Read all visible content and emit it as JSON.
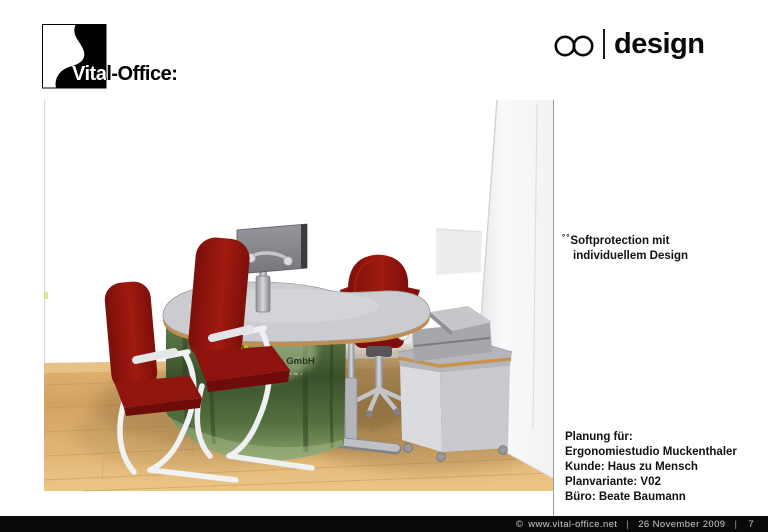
{
  "header": {
    "brand": "Vital-Office:",
    "design_wordmark": "design",
    "infinity_icon": "infinity-icon"
  },
  "annotation": {
    "prefix": "°°",
    "line1": "Softprotection mit",
    "line2": "individuellem Design"
  },
  "plan_info": {
    "line1": "Planung für:",
    "line2": "Ergonomiestudio Muckenthaler",
    "line3": "Kunde: Haus zu Mensch",
    "line4": "Planvariante: V02",
    "line5": "Büro: Beate Baumann"
  },
  "scene": {
    "panel_label": "Haus zu Mensch GmbH",
    "objects": [
      "kidney-shaped desk with forest photo front panel",
      "monitor on pole mount",
      "two red cantilever visitor chairs",
      "red swivel office chair",
      "mobile printer cabinet with printer",
      "white wall column",
      "wooden floor"
    ]
  },
  "colors": {
    "chair-red": "#8e130e",
    "desk-top": "#cbccd0",
    "wood-edge": "#c68d4a",
    "floor-light": "#e9c37f",
    "floor-dark": "#c89a5e",
    "panel-green": "#43602f",
    "logo-green": "#b9c822",
    "bar-black": "#0a0a0a"
  },
  "footer": {
    "copyright": "©",
    "website": "www.vital-office.net",
    "date": "26 November 2009",
    "separator": "|",
    "page": "7"
  }
}
